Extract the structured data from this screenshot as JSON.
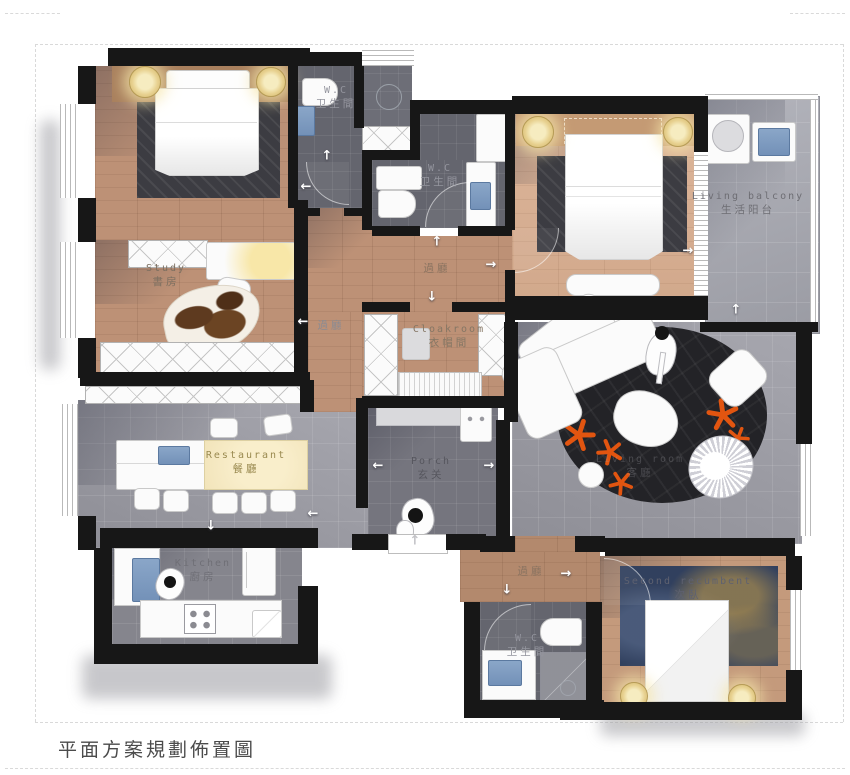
{
  "title": "平面方案規劃佈置圖",
  "labels": {
    "wc_top": {
      "en": "W.C",
      "zh": "卫生間"
    },
    "wc_mid": {
      "en": "W.C",
      "zh": "卫生間"
    },
    "wc_bottom": {
      "en": "W.C",
      "zh": "卫生間"
    },
    "study": {
      "en": "Study",
      "zh": "書房"
    },
    "living_balcony": {
      "en": "Living balcony",
      "zh": "生活阳台"
    },
    "hall_top": {
      "zh": "過廳"
    },
    "hall_left": {
      "zh": "過廳"
    },
    "hall_bottom": {
      "zh": "過廳"
    },
    "cloakroom": {
      "en": "Cloakroom",
      "zh": "衣帽間"
    },
    "living_room": {
      "en": "Living room",
      "zh": "客廳"
    },
    "restaurant": {
      "en": "Restaurant",
      "zh": "餐廳"
    },
    "porch": {
      "en": "Porch",
      "zh": "玄关"
    },
    "kitchen": {
      "en": "Kitchen",
      "zh": "廚房"
    },
    "second_bedroom": {
      "en": "Second recumbent",
      "zh": "次臥"
    }
  },
  "icons": {
    "arrow_up": "↑",
    "arrow_down": "↓",
    "arrow_left": "←",
    "arrow_right": "→"
  },
  "colors": {
    "wall": "#171717",
    "wood": "#bd9176",
    "wood_light": "#d8b197",
    "tile_gray": "#9c9ca4",
    "bath_tile": "#64656e",
    "rug_dark": "#3c3c42",
    "living_rug": "#232327",
    "accent_orange": "#e25510",
    "fixture_blue": "#7f9dc2",
    "lamp_yellow": "#eed9a0"
  }
}
